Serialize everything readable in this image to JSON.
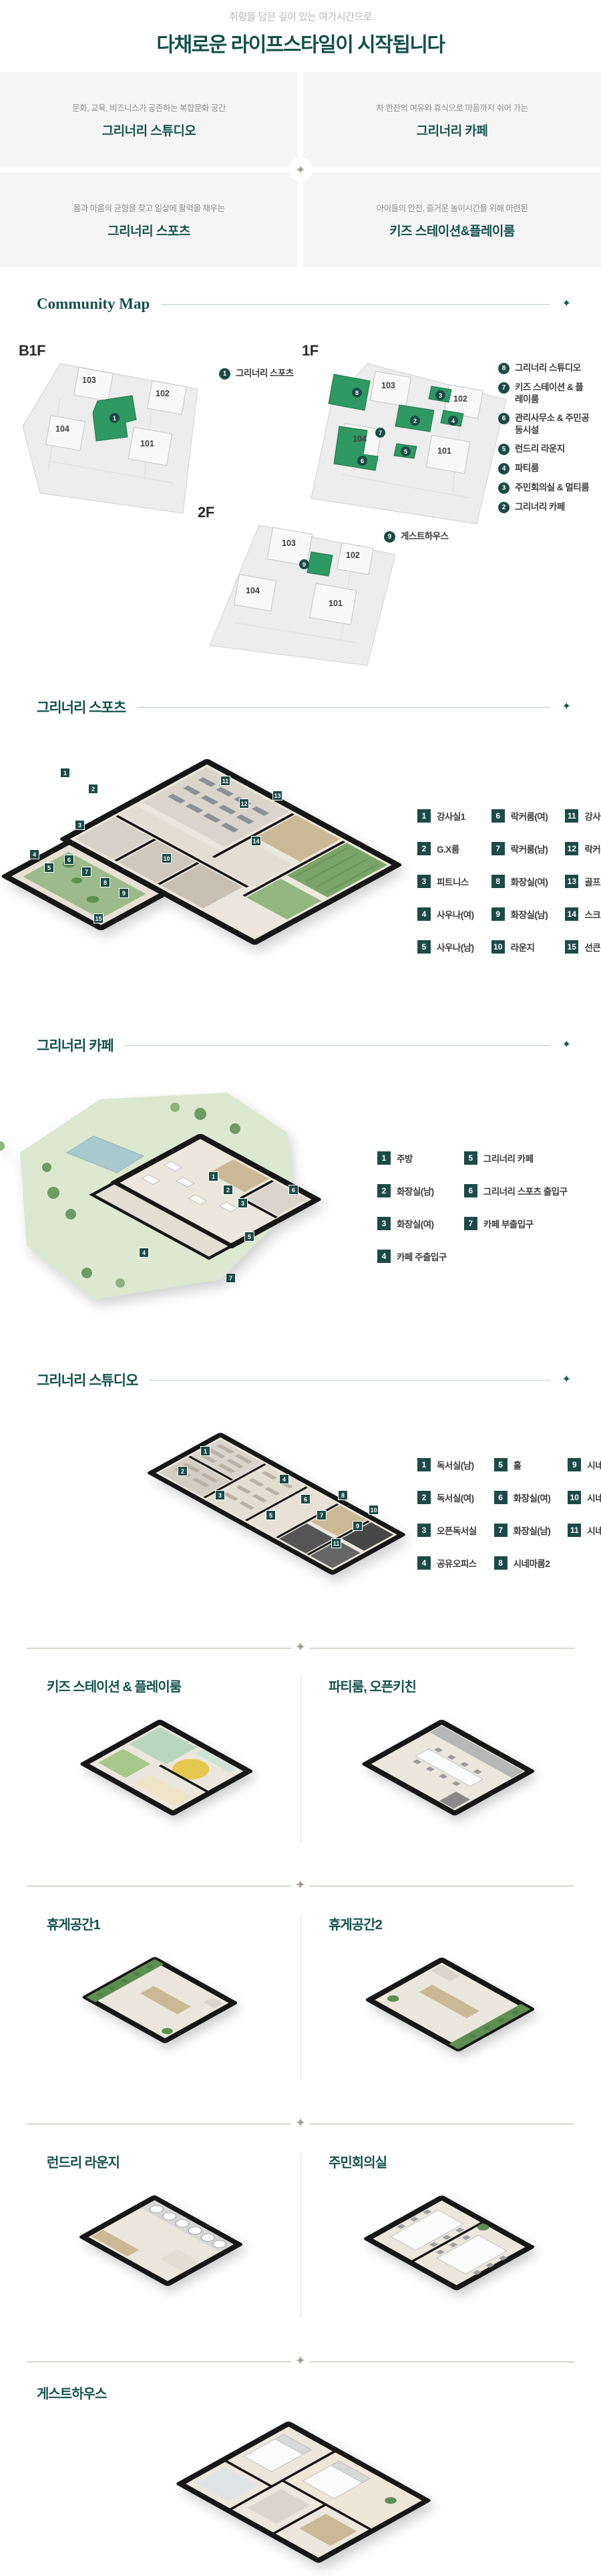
{
  "icons": {
    "sparkle": "✦"
  },
  "colors": {
    "accent_teal": "#14504B",
    "map_green": "#2F9963",
    "badge_teal": "#1C4B47",
    "divider_taupe": "#A89C8E"
  },
  "header": {
    "subtitle": "취향을 담은 깊이 있는 여가시간으로",
    "title": "다채로운 라이프스타일이 시작됩니다"
  },
  "features": [
    {
      "desc": "문화, 교육, 비즈니스가 공존하는 복합문화 공간",
      "title": "그리너리 스튜디오"
    },
    {
      "desc": "차 한잔의 여유와 휴식으로 마음까지 쉬어 가는",
      "title": "그리너리 카페"
    },
    {
      "desc": "몸과 마음의 균형을 찾고 일상에 활력을 채우는",
      "title": "그리너리 스포츠"
    },
    {
      "desc": "아이들의 안전, 즐거운 놀이시간을 위해 마련된",
      "title": "키즈 스테이션&플레이룸"
    }
  ],
  "community_map": {
    "title": "Community Map",
    "b1f": {
      "label": "B1F",
      "buildings": [
        "103",
        "102",
        "104",
        "101"
      ],
      "legend": [
        {
          "num": "1",
          "label": "그리너리 스포츠"
        }
      ]
    },
    "f1": {
      "label": "1F",
      "buildings": [
        "103",
        "102",
        "104",
        "101"
      ],
      "legend": [
        {
          "num": "8",
          "label": "그리너리 스튜디오"
        },
        {
          "num": "7",
          "label": "키즈 스테이션 & 플레이룸"
        },
        {
          "num": "6",
          "label": "관리사무소 & 주민공동시설"
        },
        {
          "num": "5",
          "label": "런드리 라운지"
        },
        {
          "num": "4",
          "label": "파티룸"
        },
        {
          "num": "3",
          "label": "주민회의실 & 멀티룸"
        },
        {
          "num": "2",
          "label": "그리너리 카페"
        }
      ]
    },
    "f2": {
      "label": "2F",
      "buildings": [
        "103",
        "102",
        "104",
        "101"
      ],
      "legend": [
        {
          "num": "9",
          "label": "게스트하우스"
        }
      ]
    }
  },
  "sports": {
    "title": "그리너리 스포츠",
    "legend": [
      {
        "num": "1",
        "label": "강사실1"
      },
      {
        "num": "2",
        "label": "G.X룸"
      },
      {
        "num": "3",
        "label": "피트니스"
      },
      {
        "num": "4",
        "label": "사우나(여)"
      },
      {
        "num": "5",
        "label": "사우나(남)"
      },
      {
        "num": "6",
        "label": "락커룸(여)"
      },
      {
        "num": "7",
        "label": "락커룸(남)"
      },
      {
        "num": "8",
        "label": "화장실(여)"
      },
      {
        "num": "9",
        "label": "화장실(남)"
      },
      {
        "num": "10",
        "label": "라운지"
      },
      {
        "num": "11",
        "label": "강사실2"
      },
      {
        "num": "12",
        "label": "락커룸"
      },
      {
        "num": "13",
        "label": "골프연습장"
      },
      {
        "num": "14",
        "label": "스크린골프"
      },
      {
        "num": "15",
        "label": "선큰"
      }
    ]
  },
  "cafe": {
    "title": "그리너리 카페",
    "legend": [
      {
        "num": "1",
        "label": "주방"
      },
      {
        "num": "2",
        "label": "화장실(남)"
      },
      {
        "num": "3",
        "label": "화장실(여)"
      },
      {
        "num": "4",
        "label": "카페 주출입구"
      },
      {
        "num": "5",
        "label": "그리너리 카페"
      },
      {
        "num": "6",
        "label": "그리너리 스포츠 출입구"
      },
      {
        "num": "7",
        "label": "카페 부출입구"
      }
    ]
  },
  "studio": {
    "title": "그리너리 스튜디오",
    "legend": [
      {
        "num": "1",
        "label": "독서실(남)"
      },
      {
        "num": "2",
        "label": "독서실(여)"
      },
      {
        "num": "3",
        "label": "오픈독서실"
      },
      {
        "num": "4",
        "label": "공유오피스"
      },
      {
        "num": "5",
        "label": "홀"
      },
      {
        "num": "6",
        "label": "화장실(여)"
      },
      {
        "num": "7",
        "label": "화장실(남)"
      },
      {
        "num": "8",
        "label": "시네마룸2"
      },
      {
        "num": "9",
        "label": "시네마라운지"
      },
      {
        "num": "10",
        "label": "시네마룸1"
      },
      {
        "num": "11",
        "label": "시네마룸3"
      }
    ]
  },
  "rooms": {
    "kids": {
      "title": "키즈 스테이션 & 플레이룸"
    },
    "party": {
      "title": "파티룸, 오픈키친"
    },
    "rest1": {
      "title": "휴게공간1"
    },
    "rest2": {
      "title": "휴게공간2"
    },
    "laundry": {
      "title": "런드리 라운지"
    },
    "meeting": {
      "title": "주민회의실"
    },
    "guesthouse": {
      "title": "게스트하우스"
    }
  }
}
